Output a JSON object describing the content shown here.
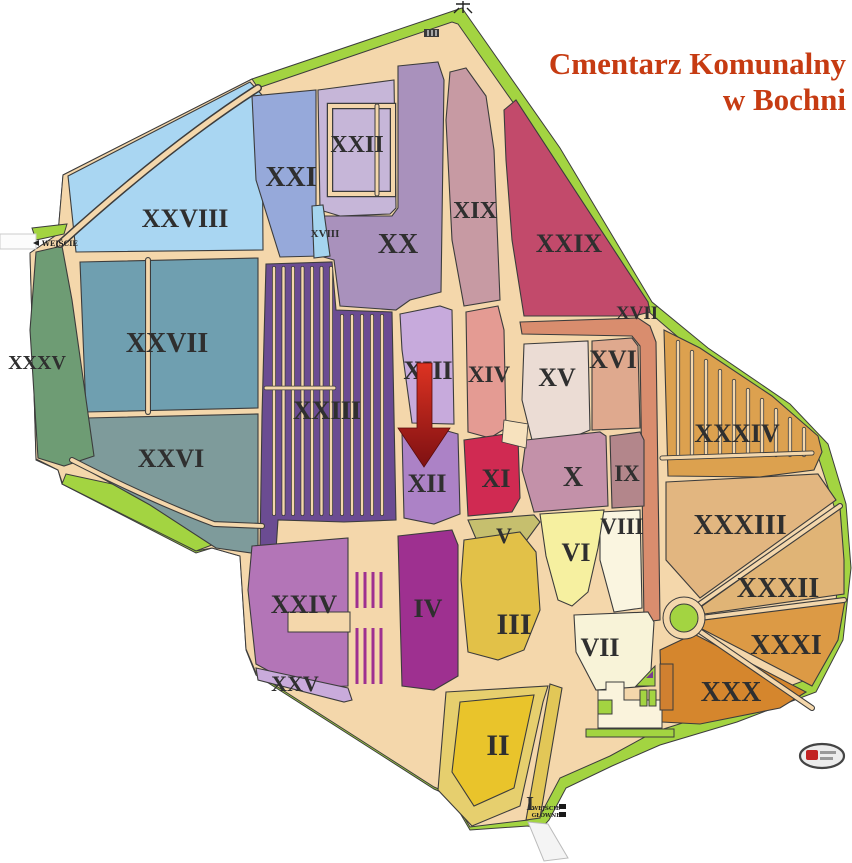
{
  "title": {
    "line1": "Cmentarz Komunalny",
    "line2": "w Bochni",
    "color": "#C63B12"
  },
  "map": {
    "colors": {
      "road": "#F4D7AB",
      "green": "#A3D441",
      "outline": "#3C3C3C",
      "label": "#2F2F2F"
    },
    "ii_outer_color": "#E6CF6E",
    "sections": [
      {
        "numeral": "I",
        "color": "#E2C757"
      },
      {
        "numeral": "II",
        "color": "#E9C42B"
      },
      {
        "numeral": "III",
        "color": "#E2C148"
      },
      {
        "numeral": "IV",
        "color": "#9E3090"
      },
      {
        "numeral": "V",
        "color": "#C6BF6E"
      },
      {
        "numeral": "VI",
        "color": "#F6F0A0"
      },
      {
        "numeral": "VII",
        "color": "#F8F3D8"
      },
      {
        "numeral": "VIII",
        "color": "#FAF5E0"
      },
      {
        "numeral": "IX",
        "color": "#B3868B"
      },
      {
        "numeral": "X",
        "color": "#C391A9"
      },
      {
        "numeral": "XI",
        "color": "#D02A52"
      },
      {
        "numeral": "XII",
        "color": "#AC82C6"
      },
      {
        "numeral": "XIII",
        "color": "#C7AADC"
      },
      {
        "numeral": "XIV",
        "color": "#E49B93"
      },
      {
        "numeral": "XV",
        "color": "#EBDCD4"
      },
      {
        "numeral": "XVI",
        "color": "#DFA98E"
      },
      {
        "numeral": "XVII",
        "color": "#D98D6E"
      },
      {
        "numeral": "XVIII",
        "color": "#A5D5EF"
      },
      {
        "numeral": "XIX",
        "color": "#C79AA3"
      },
      {
        "numeral": "XX",
        "color": "#A991BC"
      },
      {
        "numeral": "XXI",
        "color": "#96A9DA"
      },
      {
        "numeral": "XXII",
        "color": "#C6B6D8"
      },
      {
        "numeral": "XXIII",
        "color": "#6B4C92"
      },
      {
        "numeral": "XXIV",
        "color": "#B375B7"
      },
      {
        "numeral": "XXV",
        "color": "#C9ABDB"
      },
      {
        "numeral": "XXVI",
        "color": "#7E9B9B"
      },
      {
        "numeral": "XXVII",
        "color": "#6F9FB0"
      },
      {
        "numeral": "XXVIII",
        "color": "#A9D6F2"
      },
      {
        "numeral": "XXIX",
        "color": "#C24A6B"
      },
      {
        "numeral": "XXX",
        "color": "#D5862D"
      },
      {
        "numeral": "XXXI",
        "color": "#DC9A45"
      },
      {
        "numeral": "XXXII",
        "color": "#E0B476"
      },
      {
        "numeral": "XXXIII",
        "color": "#E2B680"
      },
      {
        "numeral": "XXXIV",
        "color": "#DCA14F"
      },
      {
        "numeral": "XXXV",
        "color": "#6E9C74"
      }
    ],
    "entrances": {
      "side_label": "WEJŚCIE",
      "main_line1": "WEJŚCIE",
      "main_line2": "GŁÓWNE"
    },
    "arrow": {
      "target_section": "XII",
      "color_top": "#DD3322",
      "color_bottom": "#7E1012"
    }
  }
}
